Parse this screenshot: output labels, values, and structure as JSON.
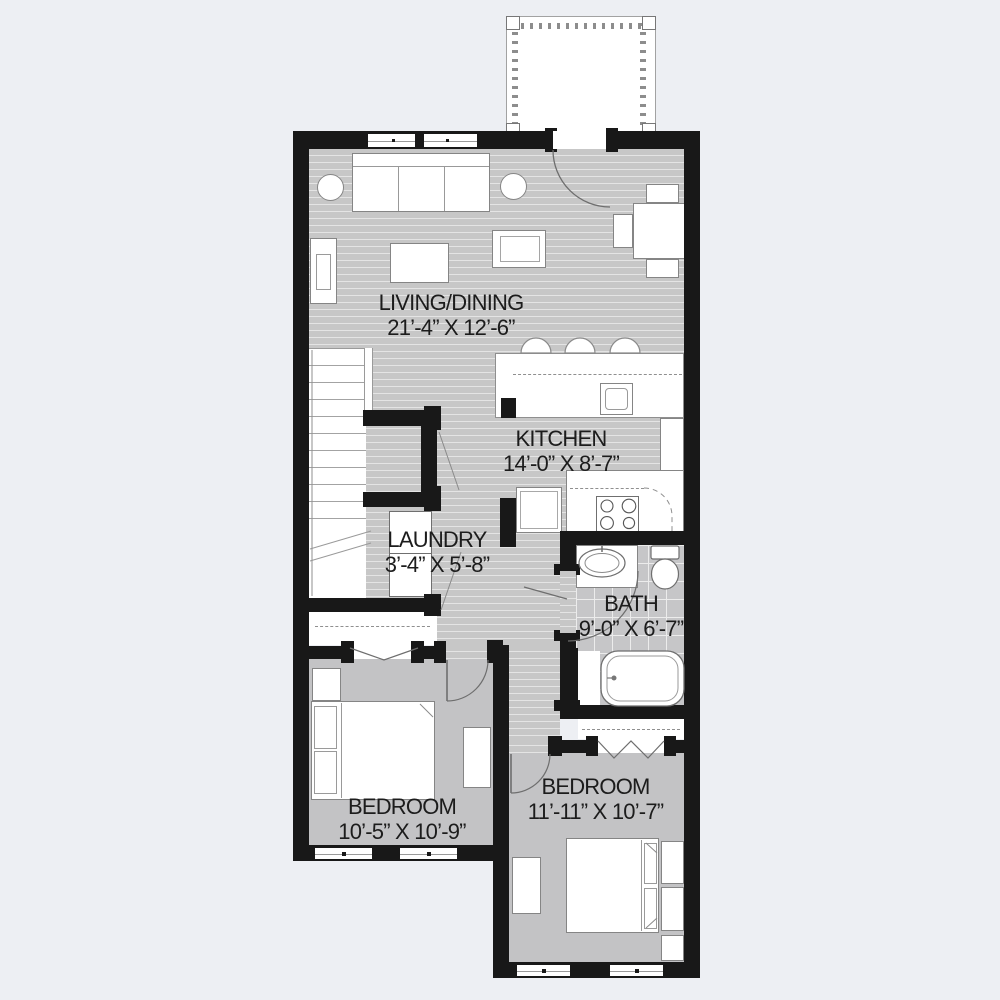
{
  "plan": {
    "rooms": [
      {
        "name": "LIVING/DINING",
        "dims": "21’-4” X 12’-6”"
      },
      {
        "name": "KITCHEN",
        "dims": "14’-0” X 8’-7”"
      },
      {
        "name": "LAUNDRY",
        "dims": "3’-4” X 5’-8”"
      },
      {
        "name": "BATH",
        "dims": "9’-0” X 6’-7”"
      },
      {
        "name": "BEDROOM",
        "dims": "10’-5” X 10’-9”"
      },
      {
        "name": "BEDROOM",
        "dims": "11’-11” X 10’-7”"
      }
    ],
    "colors": {
      "background": "#edeff3",
      "wall": "#181818",
      "wood_floor": "#c7c7c7",
      "wood_stripe": "#e4e4e4",
      "carpet_floor": "#c3c3c5",
      "tile_floor": "#c6c6c8",
      "fixture_fill": "#ffffff",
      "fixture_line": "#7a7a7a",
      "label_text": "#1c1c1c"
    }
  }
}
